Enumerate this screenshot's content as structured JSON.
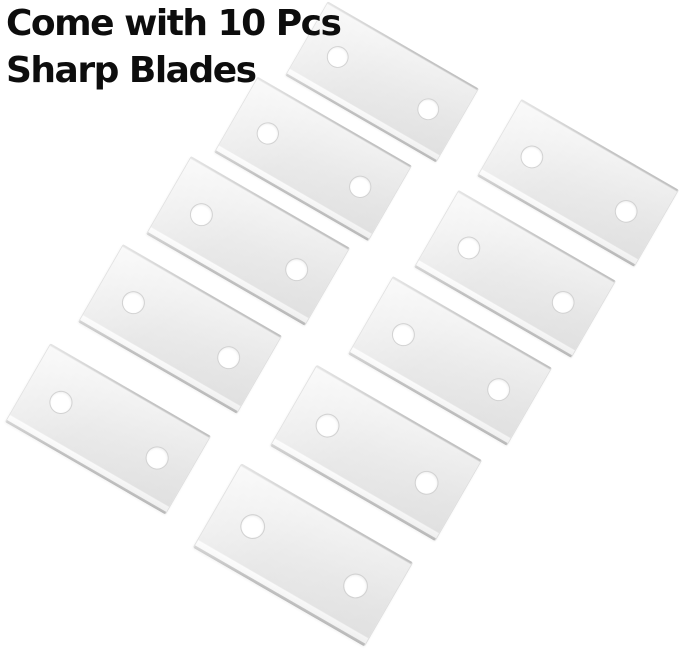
{
  "caption": {
    "line1": "Come with 10 Pcs",
    "line2": "Sharp Blades",
    "color": "#0d0d0d"
  },
  "scene": {
    "background_color": "#ffffff",
    "blade_count": 10,
    "blade": {
      "width": 184,
      "height": 90,
      "rotation_deg": 30,
      "hole_radius": 10.5,
      "hole_offset_from_center": 55,
      "face_color": "#ebebeb",
      "bevel_color": "#fbfbfb",
      "edge_line_color": "#c4c4c4",
      "hole_color": "#ffffff",
      "hole_rim_color": "#d2d2d2"
    },
    "blades": [
      {
        "label": "blade-1",
        "cx": 382,
        "cy": 82,
        "scale": 0.95
      },
      {
        "label": "blade-2",
        "cx": 313,
        "cy": 159,
        "scale": 0.97
      },
      {
        "label": "blade-3",
        "cx": 248,
        "cy": 241,
        "scale": 1.0
      },
      {
        "label": "blade-4",
        "cx": 180,
        "cy": 329,
        "scale": 1.0
      },
      {
        "label": "blade-5",
        "cx": 108,
        "cy": 429,
        "scale": 1.01
      },
      {
        "label": "blade-6",
        "cx": 578,
        "cy": 183,
        "scale": 0.99
      },
      {
        "label": "blade-7",
        "cx": 515,
        "cy": 274,
        "scale": 0.99
      },
      {
        "label": "blade-8",
        "cx": 450,
        "cy": 361,
        "scale": 1.0
      },
      {
        "label": "blade-9",
        "cx": 376,
        "cy": 453,
        "scale": 1.04
      },
      {
        "label": "blade-10",
        "cx": 303,
        "cy": 555,
        "scale": 1.08
      }
    ]
  }
}
